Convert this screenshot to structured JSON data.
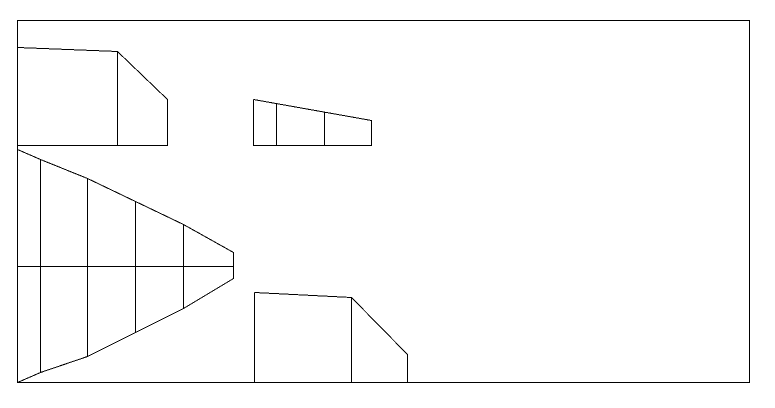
{
  "canvas": {
    "width": 775,
    "height": 408,
    "background_color": "#ffffff",
    "stroke_color": "#000000",
    "stroke_width": 1
  },
  "border": {
    "x": 17,
    "y": 20,
    "width": 732,
    "height": 362
  },
  "shapes": [
    {
      "name": "upper-left-chamfered-panel",
      "lines": [
        [
          [
            17,
            47
          ],
          [
            117,
            51
          ],
          [
            167,
            99
          ],
          [
            167,
            145
          ],
          [
            17,
            145
          ],
          [
            17,
            47
          ]
        ],
        [
          [
            117,
            51
          ],
          [
            117,
            145
          ]
        ]
      ]
    },
    {
      "name": "upper-middle-tapered-panel",
      "lines": [
        [
          [
            253,
            99
          ],
          [
            371,
            120
          ],
          [
            371,
            145
          ],
          [
            253,
            145
          ],
          [
            253,
            99
          ]
        ],
        [
          [
            276,
            103
          ],
          [
            276,
            145
          ]
        ],
        [
          [
            324,
            112
          ],
          [
            324,
            145
          ]
        ]
      ]
    },
    {
      "name": "pointed-plan-outline",
      "lines": [
        [
          [
            17,
            149
          ],
          [
            40,
            159
          ],
          [
            87,
            178
          ],
          [
            135,
            201
          ],
          [
            183,
            224
          ],
          [
            233,
            252
          ],
          [
            233,
            278
          ],
          [
            183,
            308
          ],
          [
            135,
            332
          ],
          [
            87,
            356
          ],
          [
            40,
            372
          ],
          [
            17,
            382
          ]
        ],
        [
          [
            17,
            266
          ],
          [
            233,
            266
          ]
        ],
        [
          [
            40,
            159
          ],
          [
            40,
            372
          ]
        ],
        [
          [
            87,
            178
          ],
          [
            87,
            356
          ]
        ],
        [
          [
            135,
            201
          ],
          [
            135,
            332
          ]
        ],
        [
          [
            183,
            224
          ],
          [
            183,
            308
          ]
        ]
      ]
    },
    {
      "name": "lower-middle-chamfered-panel",
      "lines": [
        [
          [
            254,
            292
          ],
          [
            351,
            297
          ],
          [
            407,
            354
          ],
          [
            407,
            382
          ],
          [
            254,
            382
          ],
          [
            254,
            292
          ]
        ],
        [
          [
            351,
            297
          ],
          [
            351,
            382
          ]
        ]
      ]
    }
  ]
}
